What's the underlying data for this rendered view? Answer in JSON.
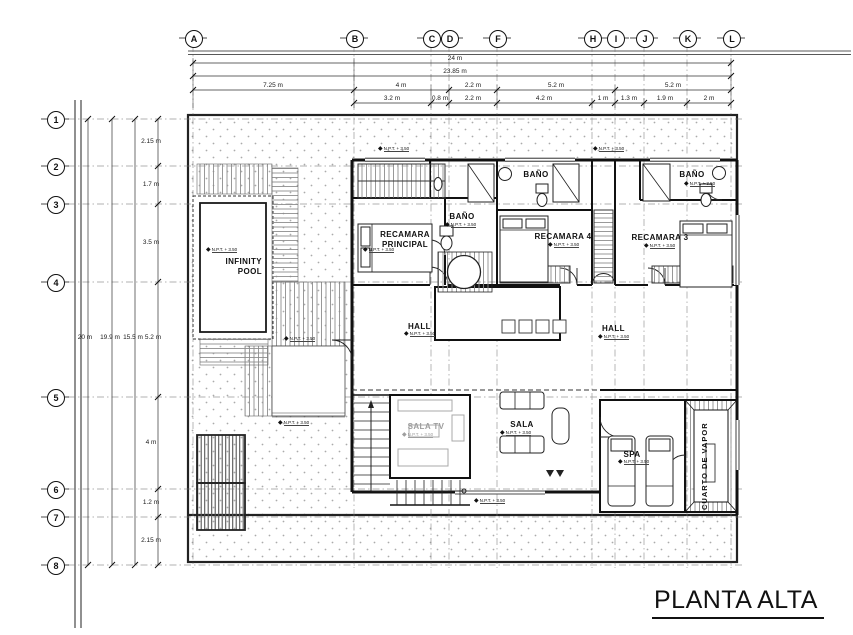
{
  "drawing": {
    "title": "PLANTA ALTA",
    "npt_label": "N.P.T. + 3.50"
  },
  "grid_cols": [
    "A",
    "B",
    "C",
    "D",
    "F",
    "H",
    "I",
    "J",
    "K",
    "L"
  ],
  "grid_rows": [
    "1",
    "2",
    "3",
    "4",
    "5",
    "6",
    "7",
    "8"
  ],
  "dims": {
    "top_total": "24 m",
    "top_subtotal": "23.85 m",
    "top_row3": [
      "7.25 m",
      "4 m",
      "2.2 m",
      "5.2 m",
      "5.2 m"
    ],
    "top_row4": [
      "3.2 m",
      "0.8 m",
      "2.2 m",
      "4.2 m",
      "1 m",
      "1.3 m",
      "1.9 m",
      "2 m"
    ],
    "left_totals": [
      "20 m",
      "19.9 m",
      "15.5 m"
    ],
    "left_intervals": [
      "2.15 m",
      "1.7 m",
      "3.5 m",
      "5.2 m",
      "4 m",
      "1.2 m",
      "2.15 m"
    ]
  },
  "rooms": {
    "infinity_pool": "INFINITY POOL",
    "recamara_principal": "RECAMARA PRINCIPAL",
    "bano_1": "BAÑO",
    "bano_2": "BAÑO",
    "bano_3": "BAÑO",
    "recamara_4": "RECAMARA 4",
    "recamara_3": "RECAMARA 3",
    "hall_1": "HALL",
    "hall_2": "HALL",
    "sala_tv": "SALA TV",
    "sala": "SALA",
    "spa": "SPA",
    "cuarto_de_vapor": "CUARTO DE VAPOR"
  }
}
